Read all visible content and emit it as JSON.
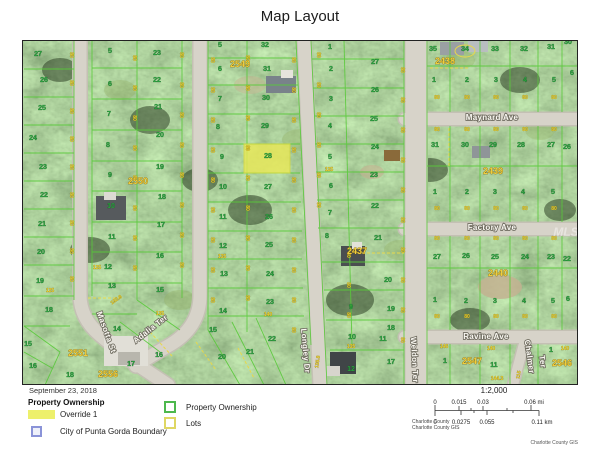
{
  "title": "Map Layout",
  "map": {
    "watermark": "MLS",
    "streets": [
      {
        "label": "Maynard Ave",
        "x": 492,
        "y": 120,
        "r": 0
      },
      {
        "label": "Factory Ave",
        "x": 492,
        "y": 230,
        "r": 0
      },
      {
        "label": "Ravine Ave",
        "x": 486,
        "y": 339,
        "r": 0
      },
      {
        "label": "Masotta St",
        "x": 104,
        "y": 333,
        "r": 70
      },
      {
        "label": "Adalia Ter",
        "x": 152,
        "y": 331,
        "r": -38
      },
      {
        "label": "Longley Dr",
        "x": 303,
        "y": 351,
        "r": 85
      },
      {
        "label": "Weldon Ter",
        "x": 412,
        "y": 360,
        "r": 87
      },
      {
        "label": "Chalmer",
        "x": 527,
        "y": 357,
        "r": 82
      },
      {
        "label": "Ter",
        "x": 540,
        "y": 362,
        "r": 82
      }
    ],
    "blocks": [
      [
        "2549",
        240,
        67
      ],
      [
        "2550",
        138,
        184
      ],
      [
        "2551",
        78,
        356
      ],
      [
        "2556",
        108,
        377
      ],
      [
        "2437",
        357,
        254
      ],
      [
        "2438",
        445,
        64
      ],
      [
        "2439",
        493,
        174
      ],
      [
        "2440",
        498,
        276
      ],
      [
        "2547",
        472,
        364
      ],
      [
        "2546",
        562,
        366
      ]
    ],
    "highlighted_parcel": {
      "number": "28",
      "fill": "#e9e857"
    },
    "parcels": [
      [
        "27",
        38,
        56
      ],
      [
        "26",
        44,
        82
      ],
      [
        "25",
        42,
        110
      ],
      [
        "24",
        33,
        140
      ],
      [
        "23",
        43,
        169
      ],
      [
        "22",
        44,
        197
      ],
      [
        "21",
        42,
        226
      ],
      [
        "20",
        41,
        254
      ],
      [
        "19",
        40,
        283
      ],
      [
        "18",
        49,
        312
      ],
      [
        "15",
        28,
        346
      ],
      [
        "16",
        33,
        368
      ],
      [
        "18",
        70,
        377
      ],
      [
        "5",
        110,
        53
      ],
      [
        "6",
        110,
        86
      ],
      [
        "7",
        109,
        116
      ],
      [
        "8",
        108,
        147
      ],
      [
        "9",
        110,
        177
      ],
      [
        "10",
        111,
        208
      ],
      [
        "11",
        112,
        239
      ],
      [
        "12",
        108,
        269
      ],
      [
        "13",
        112,
        288
      ],
      [
        "14",
        117,
        331
      ],
      [
        "23",
        157,
        55
      ],
      [
        "22",
        157,
        82
      ],
      [
        "21",
        158,
        109
      ],
      [
        "20",
        160,
        137
      ],
      [
        "19",
        160,
        169
      ],
      [
        "18",
        162,
        199
      ],
      [
        "17",
        161,
        227
      ],
      [
        "16",
        160,
        258
      ],
      [
        "15",
        160,
        292
      ],
      [
        "17",
        131,
        366
      ],
      [
        "16",
        159,
        357
      ],
      [
        "5",
        220,
        47
      ],
      [
        "6",
        220,
        71
      ],
      [
        "7",
        220,
        101
      ],
      [
        "8",
        218,
        129
      ],
      [
        "9",
        222,
        159
      ],
      [
        "10",
        223,
        189
      ],
      [
        "11",
        223,
        219
      ],
      [
        "12",
        223,
        248
      ],
      [
        "13",
        224,
        276
      ],
      [
        "14",
        223,
        313
      ],
      [
        "15",
        213,
        332
      ],
      [
        "20",
        222,
        359
      ],
      [
        "21",
        250,
        354
      ],
      [
        "32",
        265,
        47
      ],
      [
        "31",
        267,
        71
      ],
      [
        "30",
        266,
        100
      ],
      [
        "29",
        265,
        128
      ],
      [
        "28",
        268,
        158
      ],
      [
        "27",
        268,
        189
      ],
      [
        "26",
        269,
        219
      ],
      [
        "25",
        269,
        247
      ],
      [
        "24",
        270,
        276
      ],
      [
        "23",
        270,
        304
      ],
      [
        "22",
        272,
        341
      ],
      [
        "1",
        330,
        49
      ],
      [
        "2",
        331,
        71
      ],
      [
        "3",
        331,
        101
      ],
      [
        "4",
        330,
        128
      ],
      [
        "5",
        330,
        159
      ],
      [
        "6",
        331,
        188
      ],
      [
        "7",
        330,
        215
      ],
      [
        "8",
        327,
        238
      ],
      [
        "9",
        351,
        309
      ],
      [
        "10",
        352,
        339
      ],
      [
        "11",
        383,
        341
      ],
      [
        "12",
        351,
        371
      ],
      [
        "27",
        375,
        64
      ],
      [
        "26",
        375,
        92
      ],
      [
        "25",
        374,
        121
      ],
      [
        "24",
        375,
        149
      ],
      [
        "23",
        374,
        177
      ],
      [
        "22",
        375,
        208
      ],
      [
        "21",
        378,
        240
      ],
      [
        "20",
        388,
        282
      ],
      [
        "19",
        391,
        311
      ],
      [
        "18",
        391,
        330
      ],
      [
        "17",
        391,
        364
      ],
      [
        "35",
        433,
        51
      ],
      [
        "34",
        465,
        51
      ],
      [
        "33",
        495,
        51
      ],
      [
        "32",
        524,
        51
      ],
      [
        "31",
        551,
        49
      ],
      [
        "30",
        568,
        44
      ],
      [
        "1",
        434,
        82
      ],
      [
        "2",
        467,
        82
      ],
      [
        "3",
        496,
        82
      ],
      [
        "4",
        525,
        82
      ],
      [
        "5",
        554,
        82
      ],
      [
        "6",
        572,
        75
      ],
      [
        "31",
        435,
        147
      ],
      [
        "30",
        465,
        147
      ],
      [
        "29",
        493,
        147
      ],
      [
        "28",
        521,
        147
      ],
      [
        "27",
        551,
        147
      ],
      [
        "26",
        567,
        149
      ],
      [
        "1",
        435,
        194
      ],
      [
        "2",
        467,
        194
      ],
      [
        "3",
        495,
        194
      ],
      [
        "4",
        523,
        194
      ],
      [
        "5",
        553,
        194
      ],
      [
        "27",
        437,
        259
      ],
      [
        "26",
        466,
        258
      ],
      [
        "25",
        495,
        259
      ],
      [
        "24",
        525,
        259
      ],
      [
        "23",
        551,
        259
      ],
      [
        "22",
        567,
        261
      ],
      [
        "1",
        435,
        302
      ],
      [
        "2",
        466,
        303
      ],
      [
        "3",
        495,
        303
      ],
      [
        "4",
        524,
        303
      ],
      [
        "5",
        553,
        303
      ],
      [
        "6",
        568,
        301
      ],
      [
        "1",
        445,
        363
      ],
      [
        "11",
        494,
        367
      ],
      [
        "1",
        551,
        352
      ]
    ],
    "dims": [
      [
        "125",
        50,
        292,
        0
      ],
      [
        "125",
        97,
        269,
        0
      ],
      [
        "135",
        160,
        315,
        0
      ],
      [
        "192.8",
        117,
        301,
        -35
      ],
      [
        "135",
        222,
        258,
        0
      ],
      [
        "125",
        329,
        171,
        0
      ],
      [
        "140",
        268,
        316,
        0
      ],
      [
        "135",
        351,
        348,
        0
      ],
      [
        "135.8",
        319,
        362,
        -82
      ],
      [
        "146",
        444,
        348,
        0
      ],
      [
        "140",
        491,
        350,
        0
      ],
      [
        "144.3",
        497,
        380,
        0
      ],
      [
        "115",
        520,
        375,
        -80
      ],
      [
        "140",
        565,
        350,
        0
      ]
    ],
    "marks": {
      "value": "80",
      "vcols": [
        [
          70,
          [
            55,
            83,
            111,
            139,
            167,
            195,
            223,
            251,
            279
          ]
        ],
        [
          133,
          [
            58,
            88,
            118,
            148,
            178,
            208,
            238,
            268
          ]
        ],
        [
          180,
          [
            55,
            85,
            115,
            145,
            175,
            205,
            235,
            265
          ]
        ],
        [
          211,
          [
            60,
            90,
            120,
            150,
            180,
            210,
            240,
            270,
            300
          ]
        ],
        [
          246,
          [
            58,
            88,
            118,
            148,
            178,
            208,
            238,
            268,
            298
          ]
        ],
        [
          292,
          [
            60,
            90,
            120,
            150,
            180,
            210,
            240,
            270,
            300,
            330
          ]
        ],
        [
          317,
          [
            55,
            85,
            115,
            145,
            175,
            205
          ]
        ],
        [
          347,
          [
            255,
            285,
            315
          ]
        ],
        [
          401,
          [
            70,
            100,
            130,
            160,
            190,
            220,
            250,
            280,
            310,
            340
          ]
        ]
      ],
      "hrows": [
        [
          99,
          [
            437,
            467,
            496,
            525,
            554
          ]
        ],
        [
          131,
          [
            437,
            467,
            496,
            525,
            554
          ]
        ],
        [
          210,
          [
            437,
            467,
            496,
            525,
            554
          ]
        ],
        [
          240,
          [
            437,
            467,
            496,
            525,
            554
          ]
        ],
        [
          318,
          [
            437,
            467,
            496,
            525,
            554
          ]
        ]
      ]
    },
    "colors": {
      "parcel_line": "#58ca39",
      "highlight": "#e9e857",
      "block_text": "#f0cd3d",
      "number_text": "#2aa23e",
      "road": "#d7d3c9",
      "lots_dash": "#e8d84a"
    }
  },
  "footer": {
    "date": "September 23, 2018",
    "legend_title": "Property Ownership",
    "override_label": "Override 1",
    "boundary_label": "City of Punta Gorda Boundary",
    "ownership_label": "Property Ownership",
    "lots_label": "Lots"
  },
  "scalebar": {
    "ratio": "1:2,000",
    "mi": [
      "0",
      "0.015",
      "0.03",
      "0.06 mi"
    ],
    "km": [
      "0",
      "0.0275",
      "0.055",
      "0.11 km"
    ]
  },
  "credits": {
    "left_line1": "Charlotte County",
    "left_line2": "Charlotte County GIS",
    "right": "Charlotte County GIS"
  }
}
